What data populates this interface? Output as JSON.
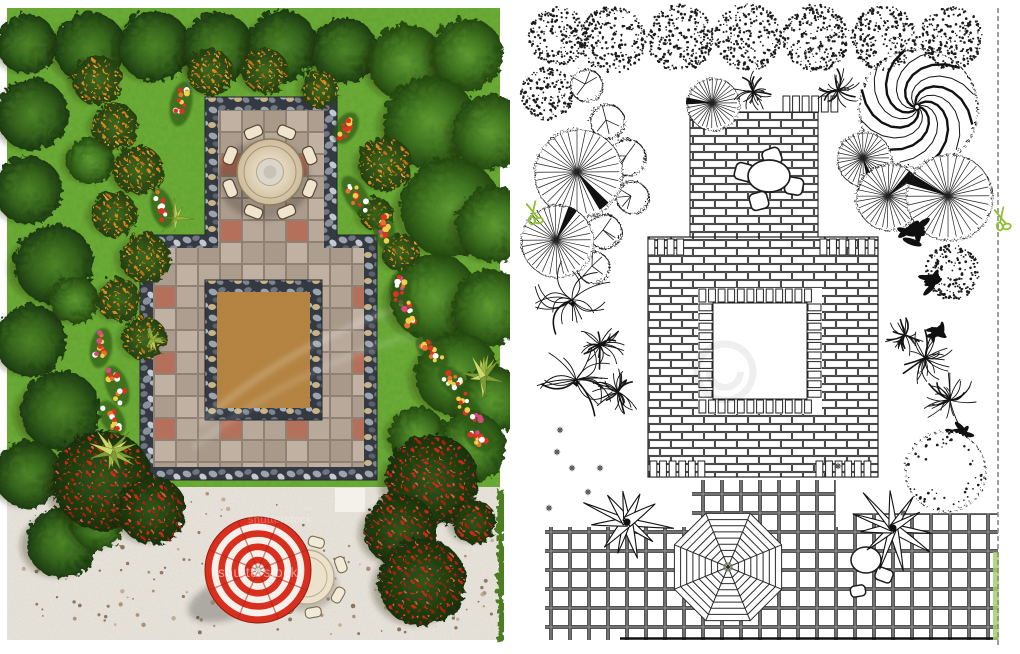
{
  "image": {
    "description": "Landscape garden design plan, top view: left panel is a color photorealistic render, right panel is the matching black-and-white line drawing",
    "width": 1020,
    "height": 654
  },
  "watermarks": {
    "brand_text": "shutterstock",
    "instances": [
      {
        "x": 218,
        "y": 577,
        "size": 13.5,
        "opacity": 0.5
      },
      {
        "x": 248,
        "y": 523,
        "size": 11,
        "opacity": 0.28
      }
    ]
  },
  "cut_marks": {
    "icon": "scissors-icon",
    "color": "#8fbf2f",
    "positions": [
      {
        "x": 533,
        "y": 212
      },
      {
        "x": 1001,
        "y": 218
      }
    ]
  },
  "palette": {
    "grass": "#61a62b",
    "gravel": "#eae6dd",
    "pebble_bg": "#343942",
    "paver_gray": "#b8a99a",
    "paver_red": "#b4705a",
    "sand": "#b5823f",
    "tree_dark": "#2c5716",
    "tree_mid": "#3f7320",
    "orange_berries": "#d97a18",
    "red_berries": "#cc2015",
    "flower_red": "#e03223",
    "flower_yellow": "#f2cf4d",
    "flower_white": "#ffffff",
    "cream_furniture": "#ecdfc6",
    "umbrella_red": "#d92f1f",
    "umbrella_white": "#f4f1ea",
    "line_ink": "#1c1c1c",
    "grid_line": "#4c4c4c",
    "hedge_green": "#4e7d22",
    "hedge_light": "#a6d06a"
  },
  "left_panel": {
    "label": "color render",
    "grass": [
      7,
      8,
      493,
      632
    ],
    "gravel": [
      7,
      487,
      493,
      153
    ],
    "gravel_patch": [
      335,
      488,
      30,
      24
    ],
    "edge_hedge": [
      495,
      487,
      7,
      153
    ],
    "pavement_outline": [
      [
        205,
        97
      ],
      [
        337,
        97
      ],
      [
        337,
        235
      ],
      [
        377,
        235
      ],
      [
        377,
        480
      ],
      [
        140,
        480
      ],
      [
        140,
        235
      ],
      [
        205,
        235
      ]
    ],
    "pavement_inner": [
      [
        218,
        110
      ],
      [
        324,
        110
      ],
      [
        324,
        248
      ],
      [
        364,
        248
      ],
      [
        364,
        467
      ],
      [
        153,
        467
      ],
      [
        153,
        248
      ],
      [
        218,
        248
      ]
    ],
    "sand_border": [
      205,
      280,
      117,
      140
    ],
    "sand": [
      217,
      292,
      93,
      116
    ],
    "dining_set": {
      "x": 270,
      "y": 172,
      "table_r": 33,
      "chairs": 8,
      "chair_dist": 43
    },
    "umbrella": {
      "x": 258,
      "y": 570,
      "r": 53,
      "gores": 8
    },
    "patio_table": {
      "x": 307,
      "y": 577,
      "r": 27,
      "chair_angles": [
        -75,
        -20,
        30,
        80,
        125
      ]
    },
    "trees_dark": [
      [
        25,
        42,
        30
      ],
      [
        88,
        46,
        36
      ],
      [
        152,
        44,
        36
      ],
      [
        216,
        46,
        36
      ],
      [
        280,
        44,
        36
      ],
      [
        342,
        48,
        33
      ],
      [
        30,
        112,
        36
      ],
      [
        26,
        188,
        34
      ],
      [
        52,
        262,
        40
      ],
      [
        28,
        338,
        36
      ],
      [
        58,
        408,
        40
      ],
      [
        26,
        472,
        34
      ],
      [
        60,
        540,
        36
      ]
    ],
    "trees_right": [
      [
        404,
        60,
        38
      ],
      [
        465,
        52,
        36
      ],
      [
        428,
        120,
        46
      ],
      [
        488,
        130,
        38
      ],
      [
        448,
        205,
        50
      ],
      [
        492,
        222,
        38
      ],
      [
        432,
        295,
        44
      ],
      [
        488,
        305,
        38
      ],
      [
        455,
        372,
        42
      ],
      [
        490,
        398,
        34
      ],
      [
        468,
        445,
        36
      ],
      [
        415,
        432,
        28
      ]
    ],
    "trees_mid": [
      [
        88,
        158,
        24
      ],
      [
        72,
        298,
        24
      ],
      [
        96,
        520,
        28
      ]
    ],
    "shrubs_orange": [
      [
        95,
        78,
        25
      ],
      [
        113,
        124,
        23
      ],
      [
        136,
        168,
        25
      ],
      [
        112,
        212,
        23
      ],
      [
        143,
        256,
        25
      ],
      [
        117,
        298,
        22
      ],
      [
        142,
        336,
        22
      ],
      [
        208,
        70,
        23
      ],
      [
        263,
        69,
        23
      ],
      [
        318,
        87,
        19
      ],
      [
        383,
        162,
        27
      ],
      [
        374,
        212,
        17
      ],
      [
        398,
        250,
        19
      ]
    ],
    "bushes_berry": [
      [
        100,
        478,
        50
      ],
      [
        150,
        508,
        34
      ],
      [
        430,
        478,
        46
      ],
      [
        398,
        528,
        36
      ],
      [
        420,
        580,
        44
      ],
      [
        472,
        520,
        22
      ]
    ],
    "yuccas": [
      [
        112,
        452,
        26
      ],
      [
        483,
        377,
        24
      ]
    ],
    "grass_tufts": [
      [
        176,
        218,
        20
      ],
      [
        152,
        340,
        15
      ]
    ],
    "flower_clusters": [
      [
        181,
        104,
        100,
        30
      ],
      [
        162,
        208,
        75,
        26
      ],
      [
        356,
        196,
        60,
        30
      ],
      [
        384,
        230,
        80,
        24
      ],
      [
        400,
        290,
        95,
        26
      ],
      [
        408,
        314,
        70,
        22
      ],
      [
        101,
        348,
        100,
        26
      ],
      [
        117,
        386,
        70,
        28
      ],
      [
        112,
        418,
        60,
        24
      ],
      [
        432,
        352,
        45,
        26
      ],
      [
        454,
        382,
        45,
        26
      ],
      [
        469,
        412,
        50,
        24
      ],
      [
        479,
        438,
        40,
        20
      ],
      [
        346,
        128,
        120,
        20
      ]
    ],
    "light_streaks": [
      "M200 423Q300 335 425 300",
      "M193 448Q300 362 432 330"
    ]
  },
  "right_panel": {
    "label": "black and white line drawing",
    "background": [
      510,
      5,
      495,
      642
    ],
    "border_line": {
      "x": 998,
      "y1": 8,
      "y2": 645
    },
    "edge_hedge": [
      993,
      552,
      6,
      88
    ],
    "grids": [
      [
        692,
        480,
        144,
        47
      ],
      [
        853,
        513,
        145,
        16
      ],
      [
        545,
        527,
        453,
        113
      ]
    ],
    "grid_bottom_line": [
      620,
      638.5,
      998,
      638.5
    ],
    "patio": {
      "rect": [
        690,
        112,
        128,
        128
      ],
      "merlon_row": [
        783,
        96,
        55,
        16
      ],
      "table": {
        "x": 769,
        "y": 176,
        "rx": 21,
        "ry": 16
      },
      "chairs": [
        [
          772,
          157,
          -20
        ],
        [
          744,
          172,
          15
        ],
        [
          794,
          186,
          10
        ],
        [
          759,
          201,
          -15
        ]
      ]
    },
    "main_square": {
      "outer": [
        648,
        237,
        230,
        240
      ],
      "void": [
        713,
        303,
        94,
        96
      ],
      "soldier_strips": [
        [
          698,
          288,
          124,
          15,
          "h"
        ],
        [
          698,
          399,
          124,
          15,
          "h"
        ],
        [
          698,
          303,
          15,
          96,
          "v"
        ],
        [
          807,
          303,
          15,
          96,
          "v"
        ]
      ],
      "dentils": [
        [
          648,
          239,
          44,
          16
        ],
        [
          820,
          239,
          58,
          16
        ],
        [
          650,
          461,
          58,
          16
        ],
        [
          816,
          461,
          60,
          16
        ]
      ]
    },
    "octagon_umbrella": {
      "x": 728,
      "y": 567,
      "r": 58,
      "rings": 8
    },
    "line_chairs": [
      {
        "type": "ellipse",
        "x": 866,
        "y": 560,
        "rx": 15,
        "ry": 13
      },
      {
        "type": "rect",
        "x": 884,
        "y": 575,
        "w": 17,
        "h": 13,
        "rot": 20
      },
      {
        "type": "rect",
        "x": 858,
        "y": 591,
        "w": 15,
        "h": 11,
        "rot": -10
      }
    ],
    "stipple_trees": [
      [
        558,
        36,
        29
      ],
      [
        612,
        40,
        33
      ],
      [
        680,
        38,
        33
      ],
      [
        748,
        37,
        33
      ],
      [
        816,
        38,
        33
      ],
      [
        884,
        38,
        32
      ],
      [
        951,
        38,
        31
      ],
      [
        547,
        94,
        26
      ],
      [
        952,
        272,
        27
      ]
    ],
    "spiral_tree": [
      917,
      107,
      58
    ],
    "lobed_trees": [
      [
        585,
        84,
        16
      ],
      [
        606,
        120,
        17
      ],
      [
        626,
        156,
        18
      ],
      [
        631,
        196,
        16
      ],
      [
        603,
        230,
        17
      ],
      [
        592,
        266,
        16
      ]
    ],
    "fan_trees": [
      [
        577,
        172,
        44
      ],
      [
        556,
        240,
        36
      ],
      [
        712,
        103,
        26
      ],
      [
        863,
        158,
        27
      ],
      [
        888,
        196,
        33
      ],
      [
        948,
        196,
        43
      ]
    ],
    "palm_bursts": [
      [
        753,
        92,
        20
      ],
      [
        838,
        90,
        22
      ],
      [
        600,
        345,
        24
      ],
      [
        618,
        392,
        26
      ],
      [
        925,
        358,
        30
      ],
      [
        950,
        400,
        28
      ],
      [
        905,
        335,
        20
      ]
    ],
    "carex_grass": [
      [
        572,
        300,
        40
      ],
      [
        576,
        380,
        42
      ]
    ],
    "dark_leaves": [
      [
        916,
        232,
        20
      ],
      [
        933,
        282,
        16
      ],
      [
        958,
        432,
        16
      ],
      [
        938,
        330,
        14
      ]
    ],
    "agaves": [
      [
        627,
        522,
        46
      ],
      [
        893,
        528,
        44
      ]
    ],
    "dashed_bush": [
      944,
      470,
      40
    ],
    "star_flowers": [
      [
        557,
        452
      ],
      [
        572,
        468
      ],
      [
        549,
        508
      ],
      [
        600,
        468
      ],
      [
        838,
        466
      ],
      [
        903,
        513
      ],
      [
        560,
        430
      ],
      [
        588,
        492
      ]
    ],
    "faint_swirl": {
      "x": 725,
      "y": 372,
      "r": 28,
      "opacity": 0.06
    }
  }
}
